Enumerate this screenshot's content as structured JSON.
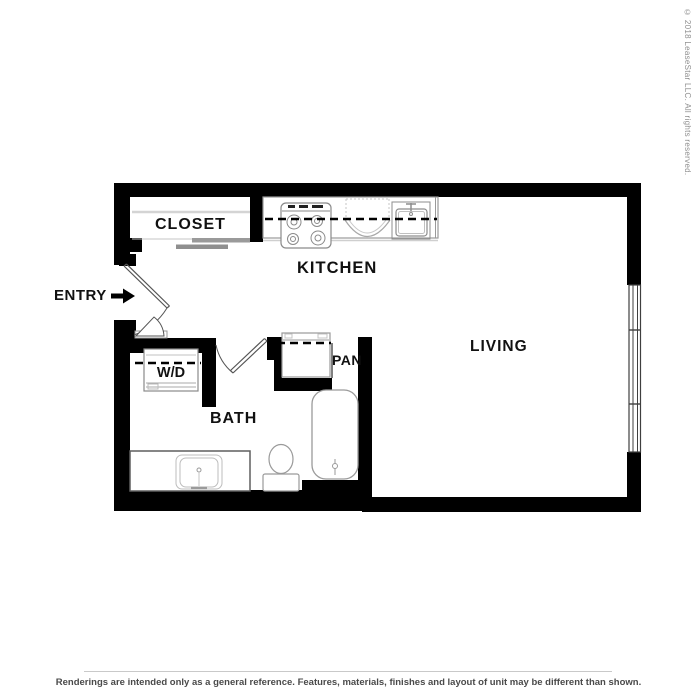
{
  "labels": {
    "closet": "CLOSET",
    "kitchen": "KITCHEN",
    "living": "LIVING",
    "entry": "ENTRY",
    "washer_dryer": "W/D",
    "bath": "BATH",
    "pantry": "PAN"
  },
  "copyright": "© 2018 LeaseStar LLC. All rights reserved.",
  "footer": {
    "disclaimer": "Renderings are intended only as a general reference. Features, materials, finishes and layout of unit may be different than shown."
  },
  "colors": {
    "wall": "#000000",
    "fixture_outline": "#999999",
    "label_text": "#111111",
    "copyright_text": "#8f8f8f",
    "disclaimer_text": "#4a4a4a",
    "background": "#ffffff"
  }
}
